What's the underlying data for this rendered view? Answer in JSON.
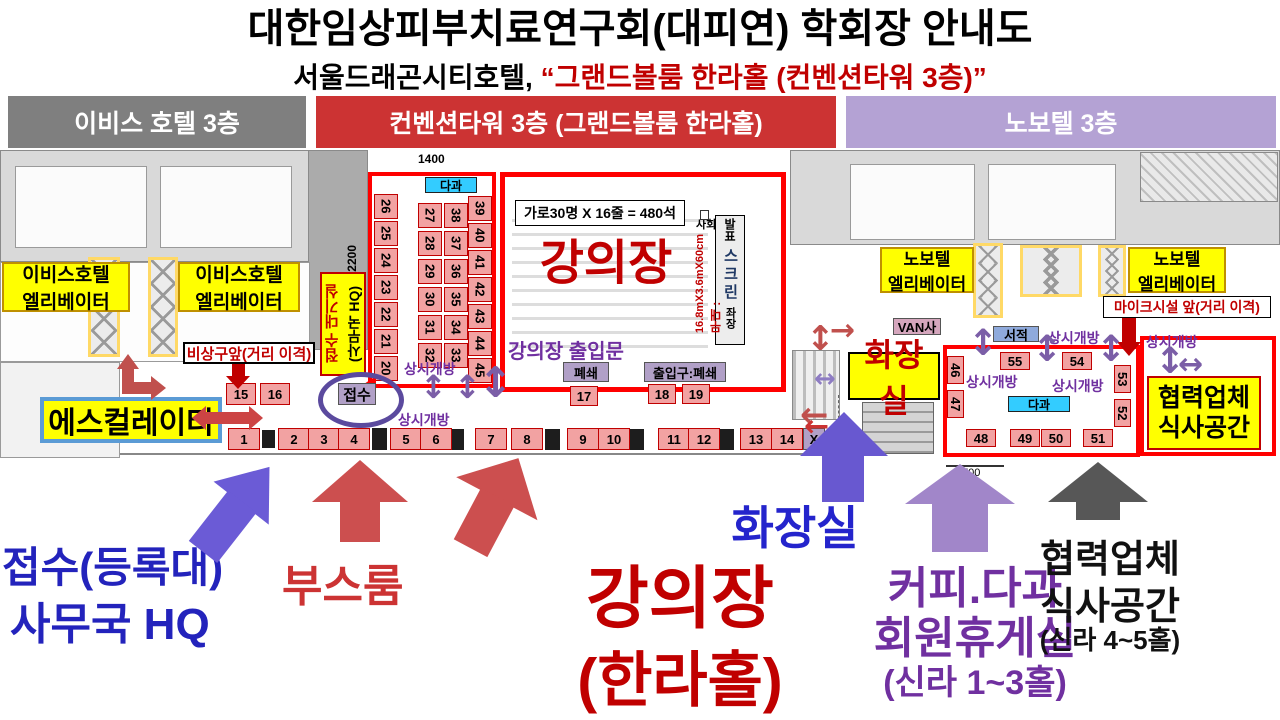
{
  "title": "대한임상피부치료연구회(대피연) 학회장 안내도",
  "subtitle": {
    "prefix": "서울드래곤시티호텔,",
    "highlight": "“그랜드볼룸 한라홀 (컨벤션타워 3층)”"
  },
  "headers": {
    "ibis": "이비스 호텔 3층",
    "convention": "컨벤션타워 3층 (그랜드볼룸 한라홀)",
    "novotel": "노보텔 3층"
  },
  "labels": {
    "open": "상시개방",
    "tea": "다과",
    "ibis_elevator_l1": "이비스호텔",
    "ibis_elevator_l2": "엘리베이터",
    "novotel_elevator_l1": "노보텔",
    "novotel_elevator_l2": "엘리베이터",
    "emergency_exit": "비상구앞(거리 이격)",
    "escalator": "에스컬레이터",
    "reception_waiting_l1": "접수 대기실",
    "reception_waiting_l2": "(사무국 HQ)",
    "reception_desk": "접수",
    "capacity": "가로30명 X 16줄 = 480석",
    "hall_name": "강의장",
    "hall_door": "강의장 출입문",
    "closed": "폐쇄",
    "entrance_closed": "출입구:폐쇄",
    "host": "사회",
    "presenter": "발표",
    "screen": "스크린",
    "chair": "좌장",
    "stage_size": "16.8mX3.6mX60cm",
    "stage": "무대 :",
    "mic_notice": "마이크시설 앞(거리 이격)",
    "van": "VAN사",
    "books": "서적",
    "restroom": "화장실",
    "partner_l1": "협력업체",
    "partner_l2": "식사공간",
    "dim_width": "1400",
    "dim_height": "2200",
    "dim_coffee": "700"
  },
  "booths": {
    "room_left": [
      "26",
      "25",
      "24",
      "23",
      "22",
      "21",
      "20"
    ],
    "room_mid_a": [
      "27",
      "28",
      "29",
      "30",
      "31",
      "32"
    ],
    "room_mid_b": [
      "38",
      "37",
      "36",
      "35",
      "34",
      "33"
    ],
    "room_right": [
      "39",
      "40",
      "41",
      "42",
      "43",
      "44",
      "45"
    ],
    "pair_15_16": [
      "15",
      "16"
    ],
    "booth_17": "17",
    "pair_18_19": [
      "18",
      "19"
    ],
    "bottom_row": [
      "1",
      "2",
      "3",
      "4",
      "5",
      "6",
      "7",
      "8",
      "9",
      "10",
      "11",
      "12",
      "13",
      "14",
      "X"
    ],
    "coffee_left": [
      "46",
      "47"
    ],
    "coffee_top": [
      "55",
      "54"
    ],
    "coffee_right": [
      "53",
      "52"
    ],
    "coffee_bottom": [
      "48",
      "49",
      "50",
      "51"
    ]
  },
  "legend": {
    "reception_l1": "접수(등록대)",
    "reception_l2": "사무국 HQ",
    "booth_room": "부스룸",
    "hall_l1": "강의장",
    "hall_l2": "(한라홀)",
    "restroom": "화장실",
    "coffee_l1": "커피.다과",
    "coffee_l2": "회원휴게실",
    "coffee_l3": "(신라 1~3홀)",
    "partner_l1": "협력업체",
    "partner_l2": "식사공간",
    "partner_l3": "(신라 4~5홀)"
  },
  "colors": {
    "accent_red": "#C00000",
    "bar_red": "#CC3333",
    "bar_gray": "#7F7F7F",
    "bar_purple": "#B4A2D4",
    "booth_fill": "#F2A2A2",
    "purple_text": "#7030A0",
    "legend_blue": "#2323BC",
    "cyan": "#33CCFF"
  }
}
